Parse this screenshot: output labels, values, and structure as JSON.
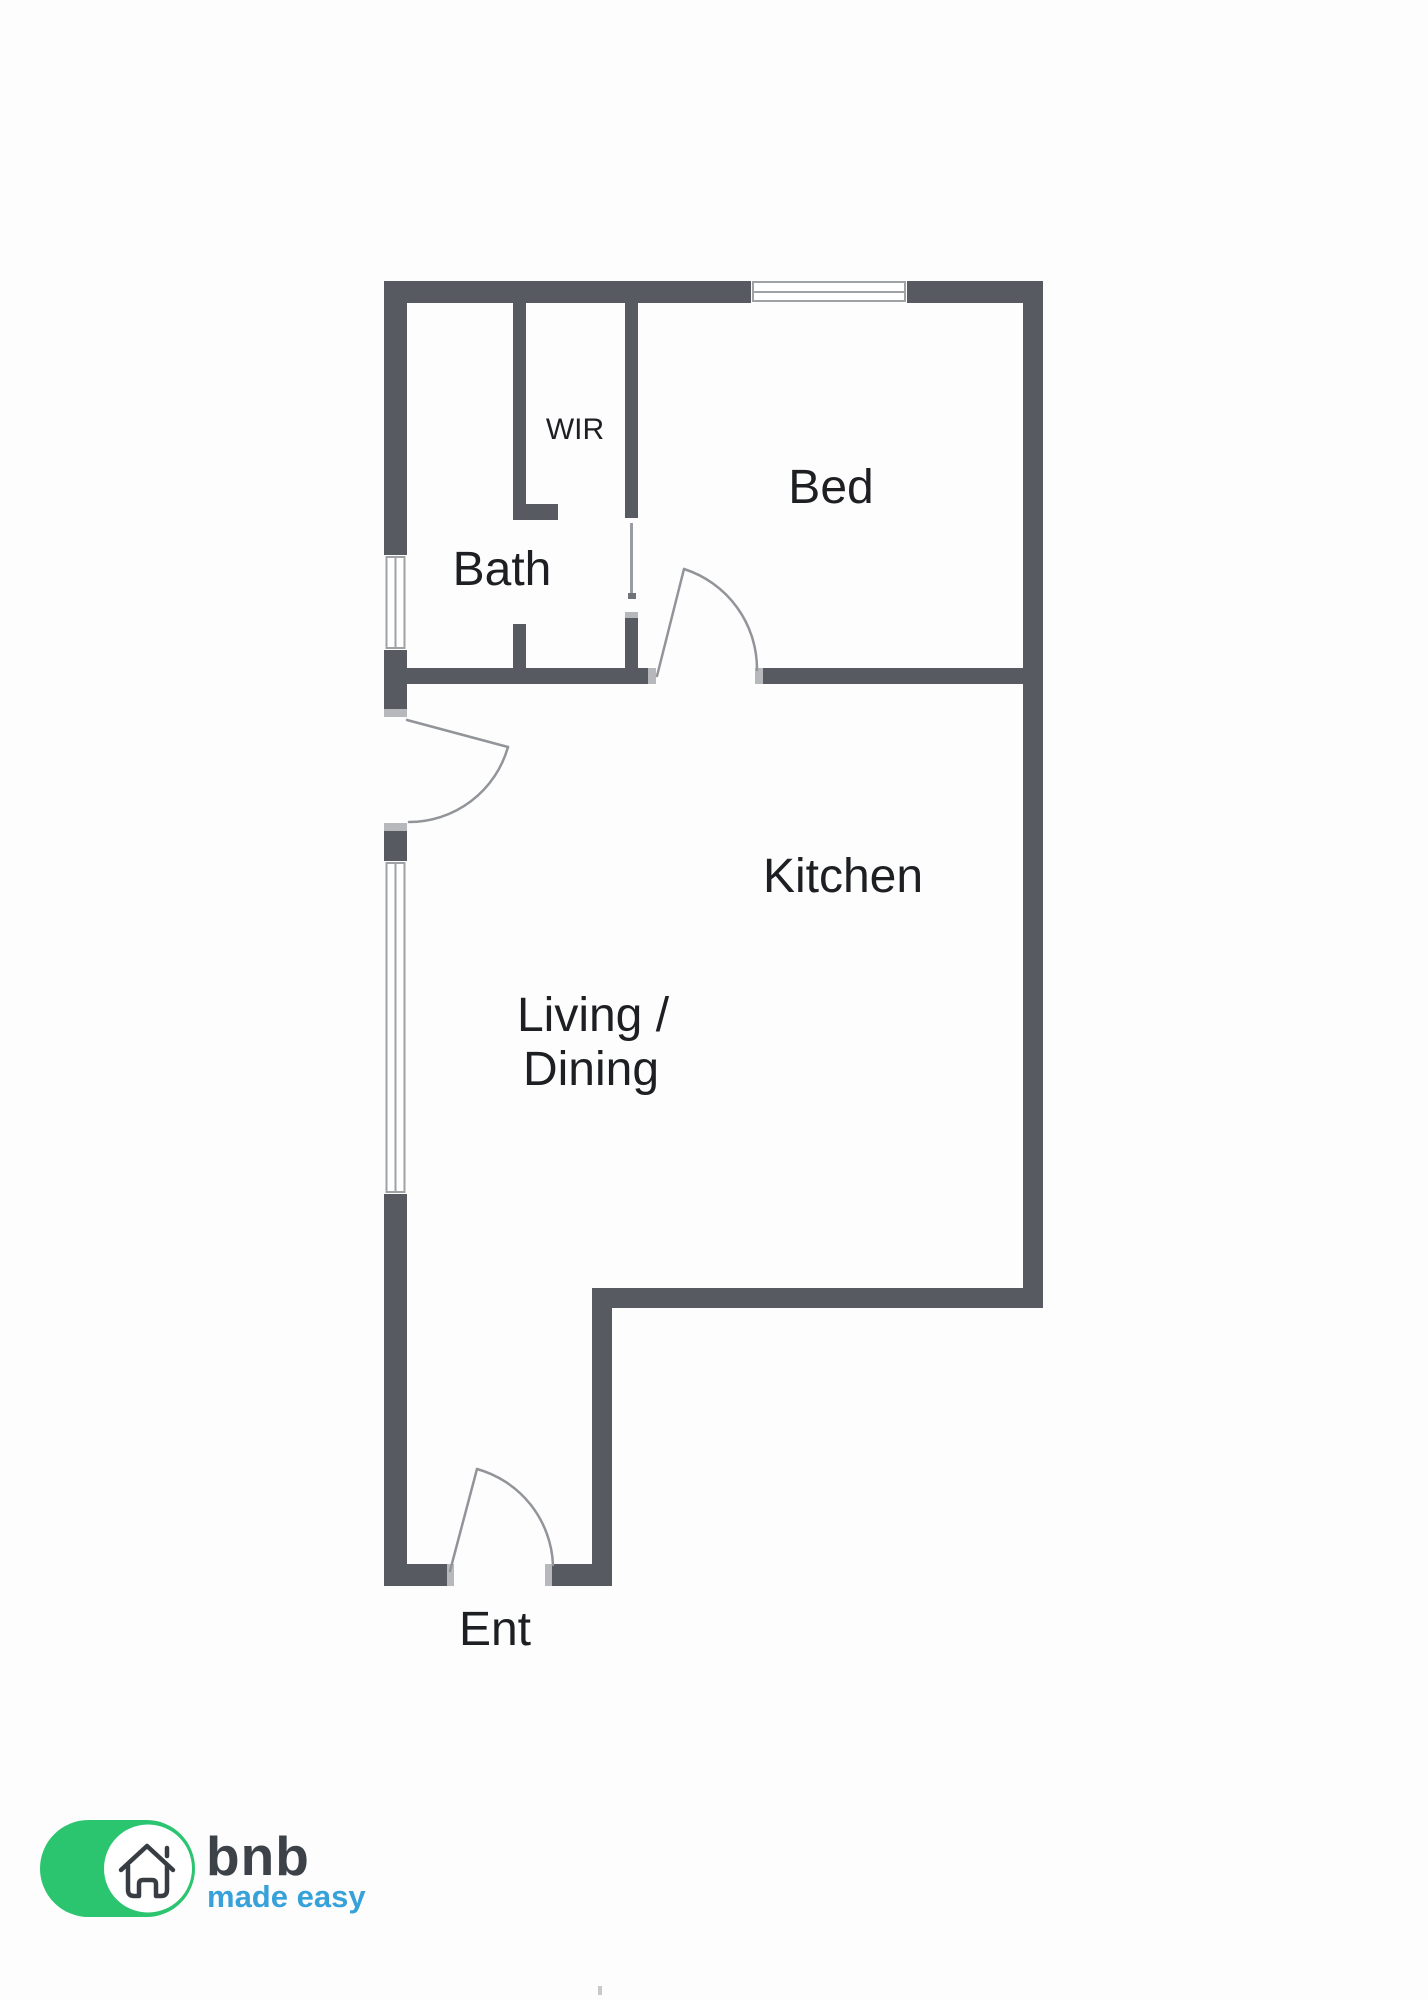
{
  "title": "Floor plan",
  "rooms": {
    "wir": {
      "label": "WIR"
    },
    "bed": {
      "label": "Bed"
    },
    "bath": {
      "label": "Bath"
    },
    "kitchen": {
      "label": "Kitchen"
    },
    "living": {
      "line1": "Living /",
      "line2": "Dining"
    },
    "entry": {
      "label": "Ent"
    }
  },
  "logo": {
    "brand": "bnb",
    "tagline": "made easy"
  },
  "colors": {
    "wall": "#575a60",
    "window_line": "#9fa2a5",
    "door_line": "#919498",
    "jamb_cap": "#b6b8bb",
    "label_text": "#1d1f23",
    "logo_green": "#2bc46f",
    "logo_blue": "#37a1da",
    "logo_dark": "#3d4249",
    "background": "#ffffff"
  }
}
